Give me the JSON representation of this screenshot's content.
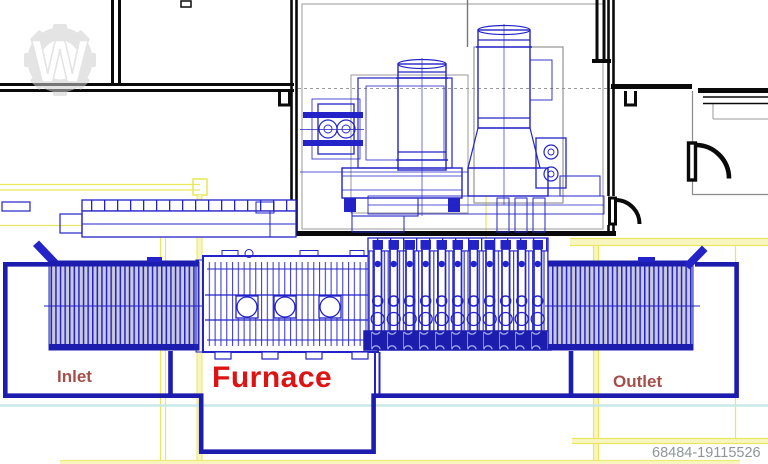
{
  "labels": {
    "inlet": "Inlet",
    "furnace": "Furnace",
    "outlet": "Outlet"
  },
  "footer": {
    "id_number": "68484-19115526"
  },
  "watermark": {
    "letter": "W"
  },
  "colors": {
    "cad-blue": "#2323c8",
    "outline-blue": "#1c1cae",
    "roller-fill": "#c9c9dd",
    "wall-black": "#0a0a0a",
    "grid-yellow": "#e9e75f",
    "grid-yellow-pale": "#f7f5c0",
    "utility-cyan": "#c9e8e6",
    "furnace-red": "#dd1414",
    "label-red": "#a64e4a",
    "id-gray": "#8e969b",
    "watermark-gray": "#cfcfcf"
  }
}
